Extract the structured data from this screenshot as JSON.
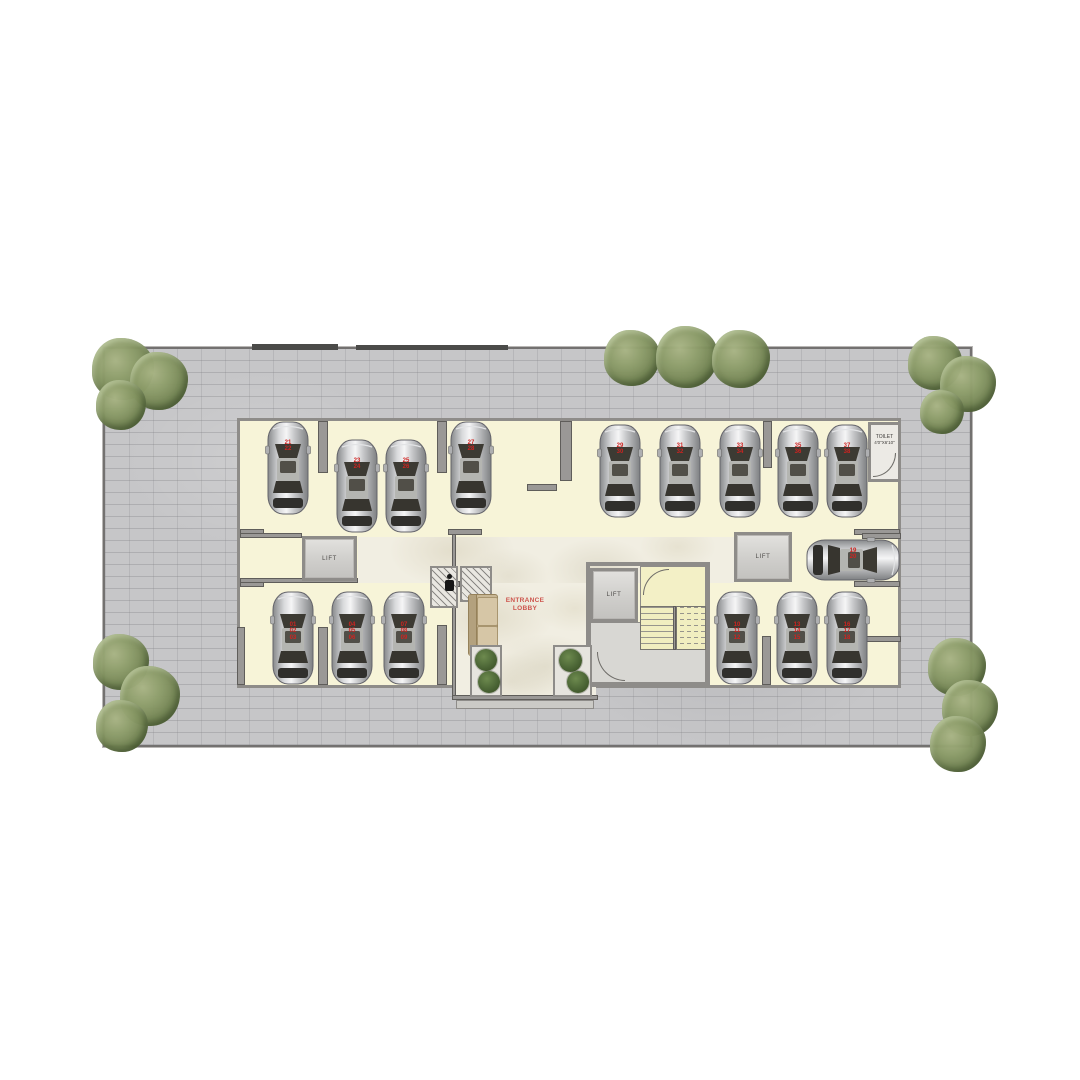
{
  "plan": {
    "labels": {
      "lift_left": "LIFT",
      "lift_center": "LIFT",
      "lift_right": "LIFT",
      "toilet_name": "TOILET",
      "toilet_size": "4'0\"X6'10\"",
      "entrance_lobby": "ENTRANCE\nLOBBY"
    },
    "parking": {
      "top_left": [
        "21\n22",
        "23\n24",
        "25\n26",
        "27\n28"
      ],
      "top_right": [
        "29\n30",
        "31\n32",
        "33\n34",
        "35\n36",
        "37\n38"
      ],
      "bottom_left": [
        "01\n02\n03",
        "04\n05\n06",
        "07\n08\n09"
      ],
      "bottom_right": [
        "10\n11\n12",
        "13\n14\n15",
        "16\n17\n18"
      ],
      "side": [
        "19\n20"
      ]
    },
    "colors": {
      "paving": "#c6c6c8",
      "floor_cream": "#f7f4d8",
      "wall_gray": "#9a9896",
      "stair_yellow": "#f1eec0",
      "spot_number_red": "#cf2320",
      "lobby_text_red": "#cd544c",
      "tree_green": "#7d8f5c"
    }
  }
}
